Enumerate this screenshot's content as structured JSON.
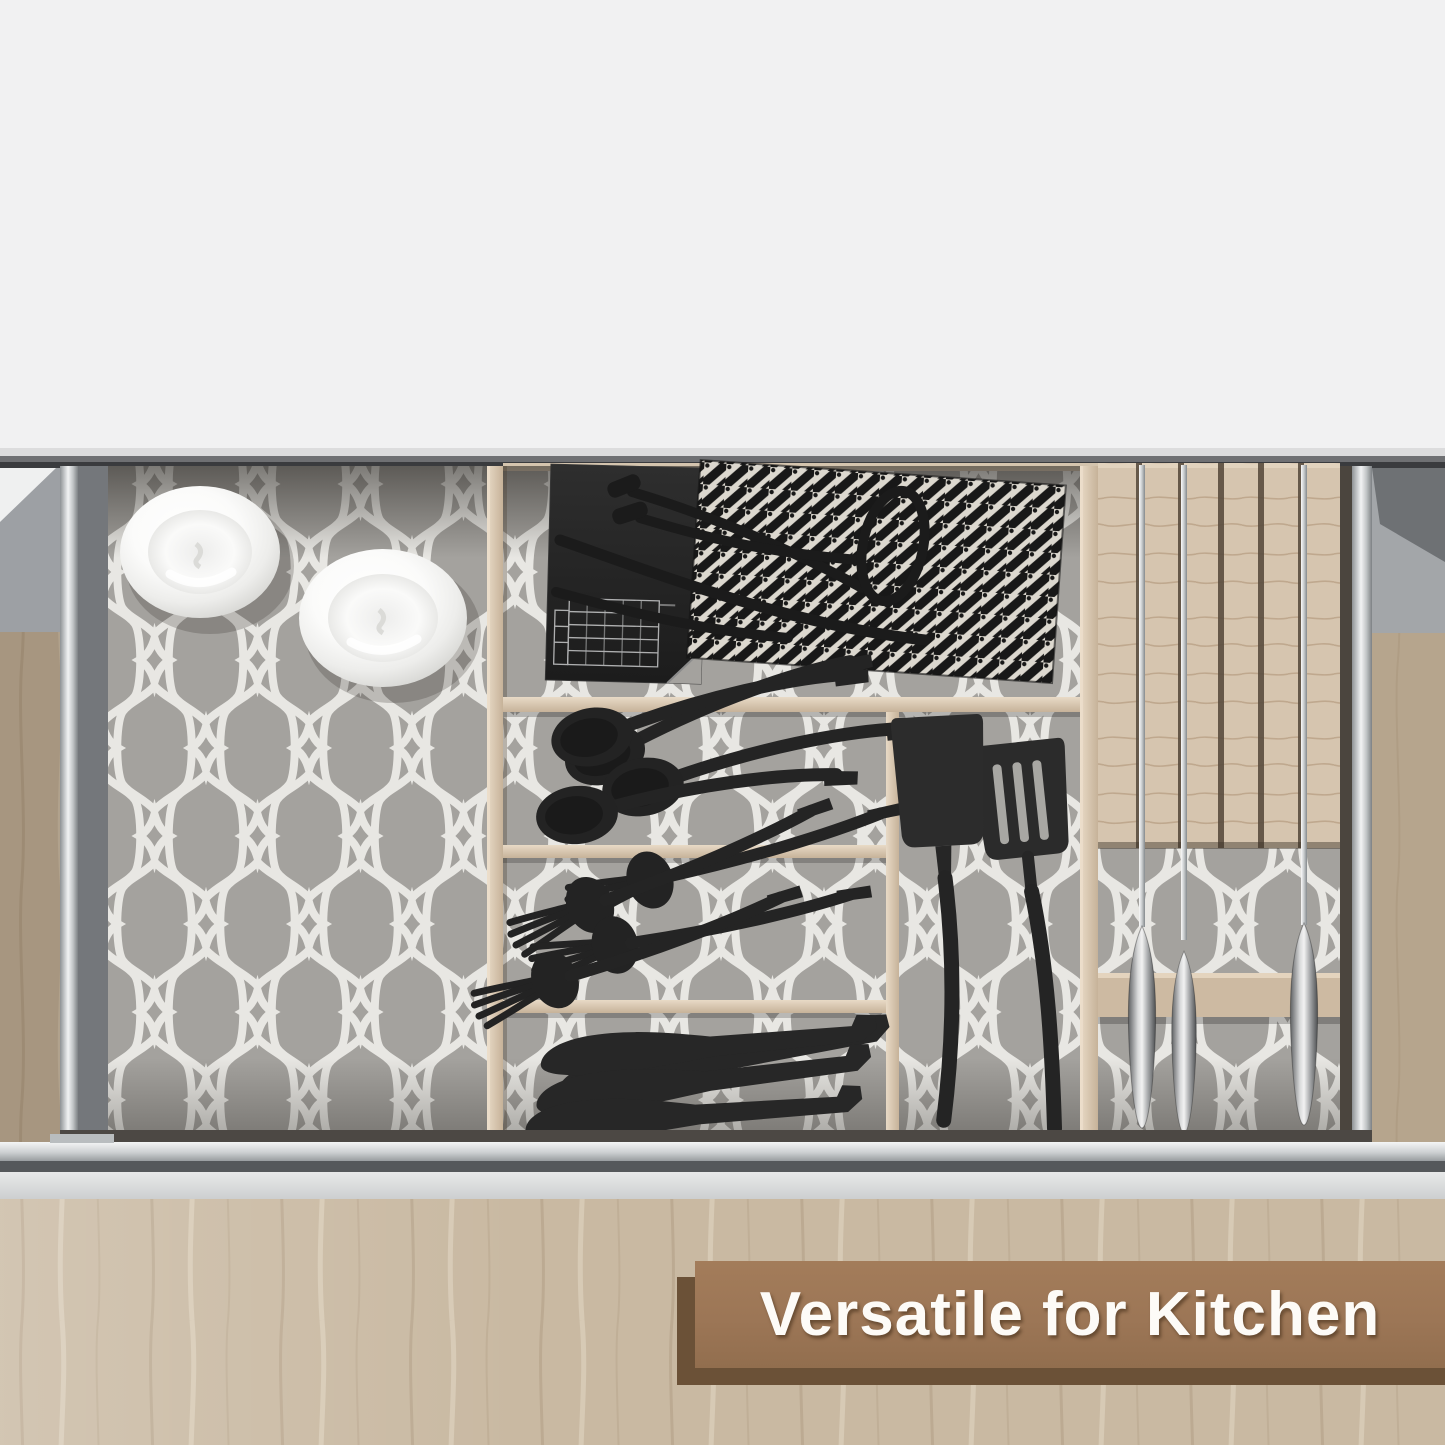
{
  "meta": {
    "type": "product-photo",
    "subject": "Open kitchen drawer with gray quatrefoil shelf liner, wood organizer compartments, black flatware, spatulas, knives in a wooden knife block and two white bowls"
  },
  "banner": {
    "text": "Versatile for Kitchen",
    "face_color": "#9c7656",
    "shadow_color": "#6b5137",
    "text_color": "#fdfbf7"
  },
  "palette": {
    "countertop": "#f1f1f2",
    "liner_gray": "#a4a29e",
    "liner_lattice_white": "#e8e7e3",
    "divider_wood": "#d8c8b2",
    "knife_block_wood": "#d6c5af",
    "cabinet_wood": "#c9b9a2",
    "utensil_black": "#262626",
    "steel": "#c7cbcd",
    "drawer_front_silver": "#ced1d3",
    "drawer_rail_silver": "#e8eaeb"
  },
  "items": {
    "bowls": 2,
    "spoons": 4,
    "forks": 4,
    "butter_knives": 4,
    "spatulas": 2,
    "block_knives": 3,
    "labels": [
      "white ceramic bowls",
      "black tongs",
      "black-and-white woven cloth",
      "black box",
      "black spoons",
      "black forks",
      "black butter knives",
      "black turners",
      "steel-handled knives in wood block"
    ]
  }
}
